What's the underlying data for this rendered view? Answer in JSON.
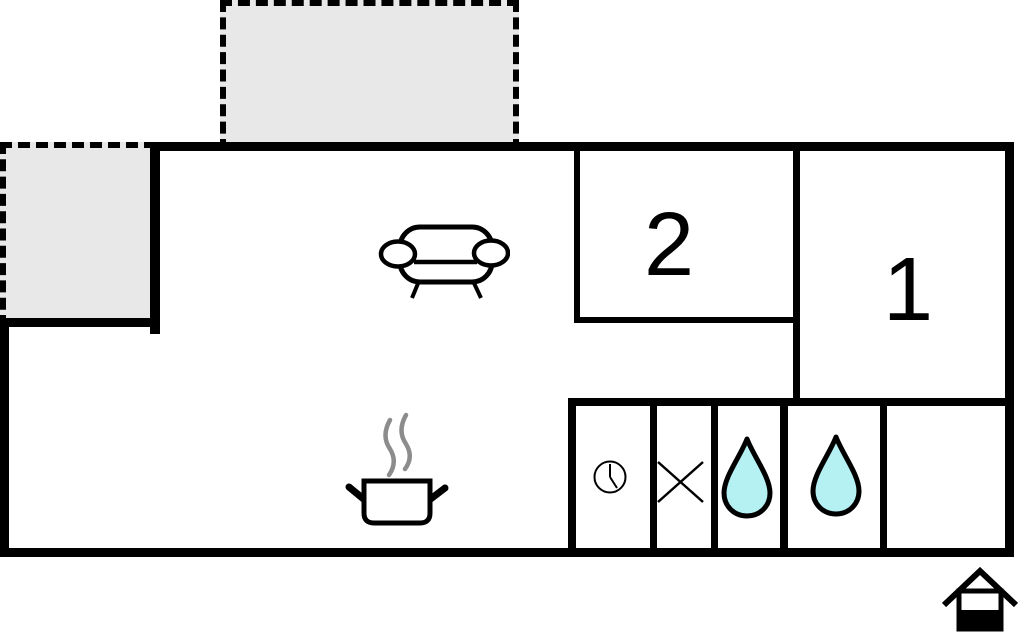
{
  "title": "floor-plan",
  "rooms": [
    {
      "id": "room-1",
      "label": "1"
    },
    {
      "id": "room-2",
      "label": "2"
    }
  ],
  "areas": {
    "terrace_top": "dashed-outdoor-area",
    "terrace_left": "dashed-outdoor-area",
    "living_kitchen": "open-plan-living-kitchen",
    "bathroom_strip": "bathroom-utility-row"
  },
  "icons": {
    "sofa": "sofa",
    "stove": "steaming-pot-stove",
    "clock": "clock",
    "window_cross": "window-cross",
    "water_drop_1": "water-drop",
    "water_drop_2": "water-drop",
    "house": "house-entrance-marker"
  },
  "colors": {
    "wall": "#000000",
    "background": "#ffffff",
    "terrace_fill": "#e8e8e8",
    "water_drop_fill": "#b5f1f3",
    "steam": "#8c8c8c"
  }
}
